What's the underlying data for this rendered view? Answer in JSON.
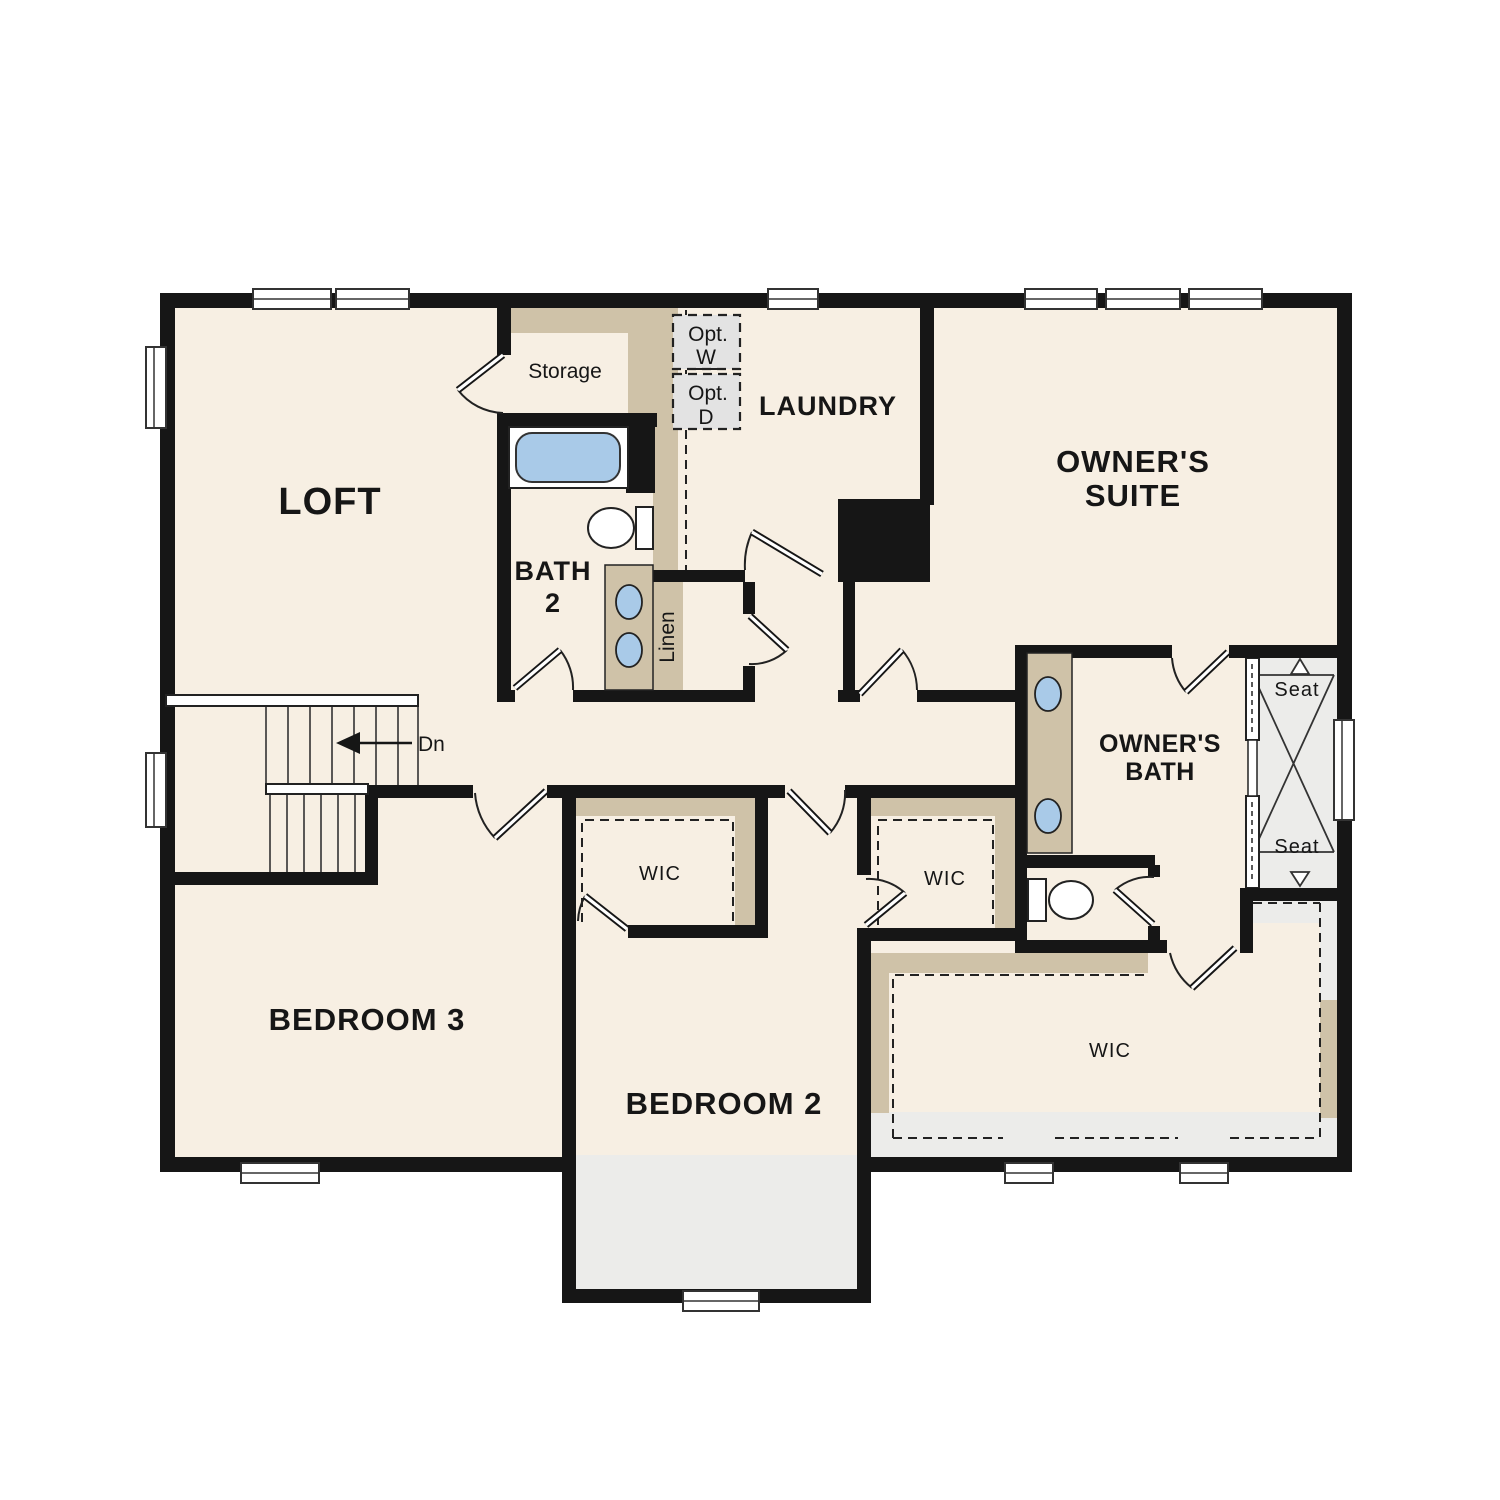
{
  "document_type": "floor-plan",
  "rooms": {
    "loft": {
      "label": "LOFT"
    },
    "storage": {
      "label": "Storage"
    },
    "bath2": {
      "line1": "BATH",
      "line2": "2"
    },
    "laundry": {
      "label": "LAUNDRY"
    },
    "owners_suite": {
      "line1": "OWNER'S",
      "line2": "SUITE"
    },
    "owners_bath": {
      "line1": "OWNER'S",
      "line2": "BATH"
    },
    "bedroom3": {
      "label": "BEDROOM 3"
    },
    "bedroom2": {
      "label": "BEDROOM 2"
    },
    "wic_bedroom3": {
      "label": "WIC"
    },
    "wic_bedroom2": {
      "label": "WIC"
    },
    "wic_owners": {
      "label": "WIC"
    },
    "linen": {
      "label": "Linen"
    }
  },
  "annotations": {
    "stairs_down": "Dn",
    "optional_washer": {
      "line1": "Opt.",
      "line2": "W"
    },
    "optional_dryer": {
      "line1": "Opt.",
      "line2": "D"
    },
    "shower_seat_top": "Seat",
    "shower_seat_bottom": "Seat"
  },
  "colors": {
    "floor_cream": "#f7efe3",
    "wall_black": "#161616",
    "cabinet_tan": "#cfc2a8",
    "fixture_blue": "#a9cae8",
    "optional_gray": "#e3e3e3",
    "floor_gray": "#ececea"
  }
}
